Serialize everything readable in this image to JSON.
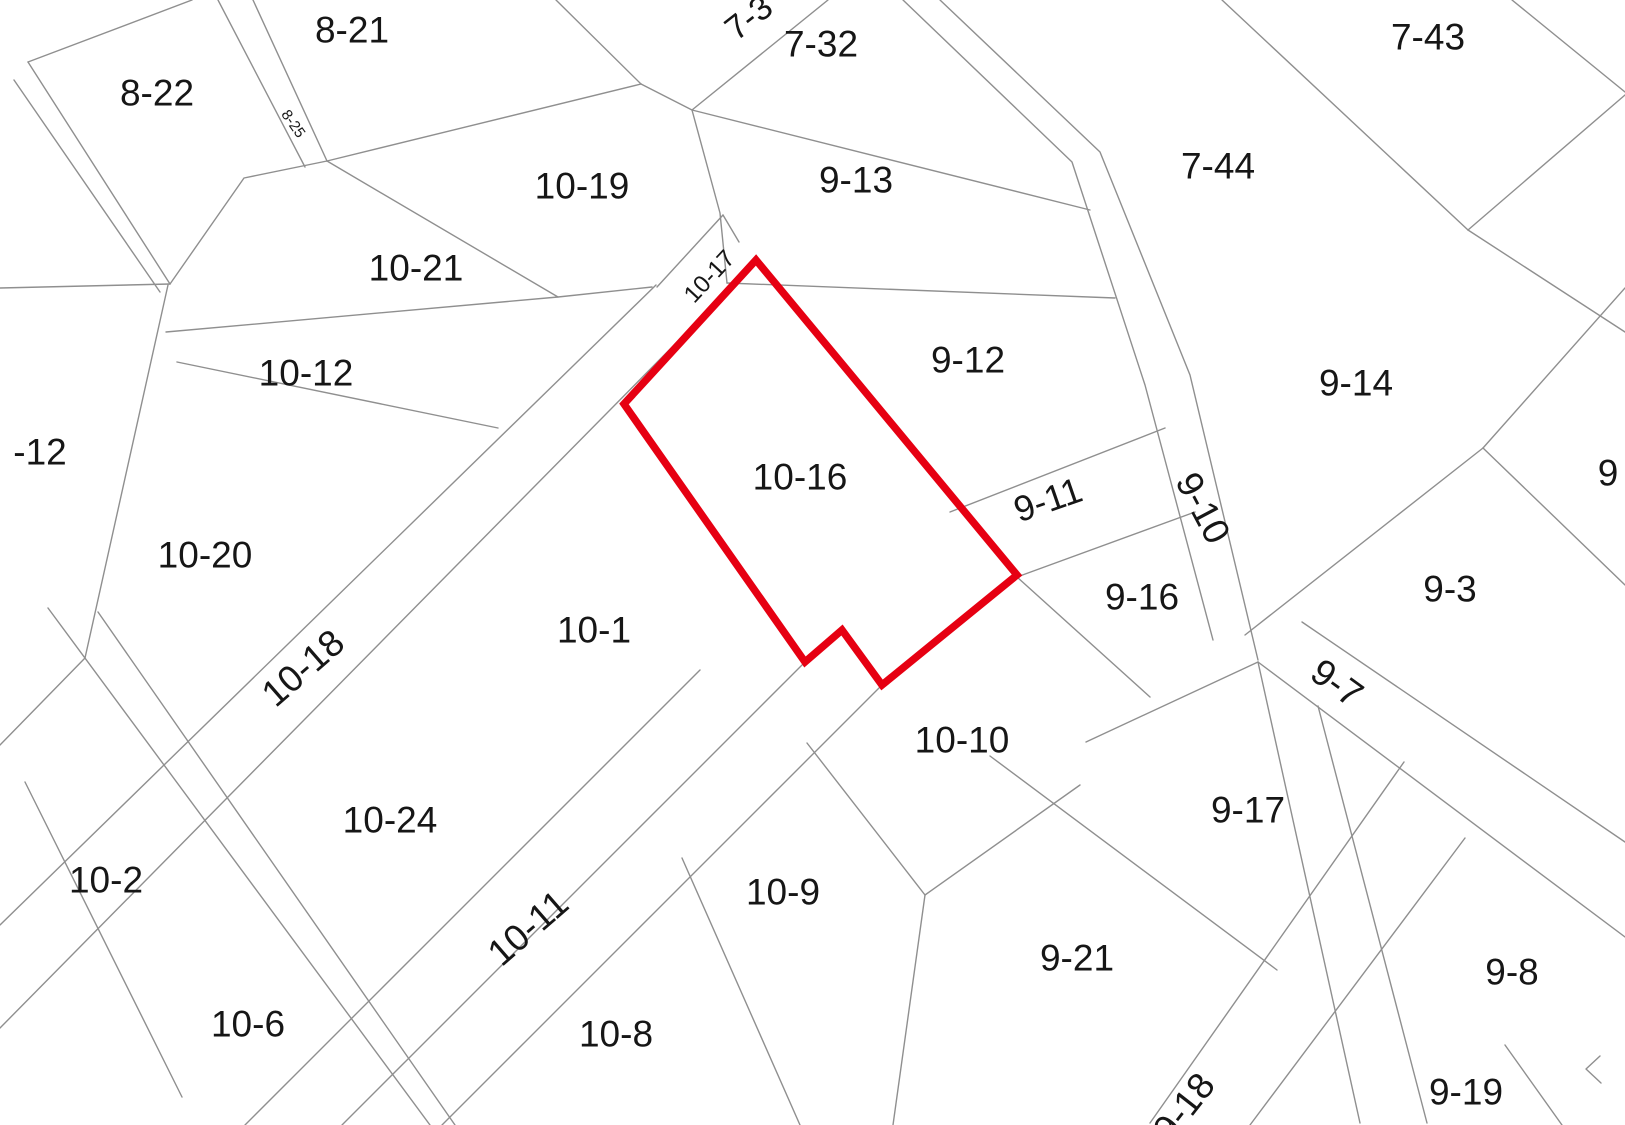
{
  "map": {
    "type": "cadastral-parcel-map",
    "background_color": "#ffffff",
    "boundary_line_color": "#8f8f8f",
    "highlight_color": "#e60012",
    "selected_parcel": "10-16",
    "labels": [
      {
        "text": "8-22",
        "x": 157,
        "y": 93
      },
      {
        "text": "8-21",
        "x": 352,
        "y": 30
      },
      {
        "text": "8-25",
        "x": 293,
        "y": 124,
        "rot": 55,
        "size": 15
      },
      {
        "text": "7-3",
        "x": 749,
        "y": 18,
        "rot": -38,
        "size": 34
      },
      {
        "text": "7-32",
        "x": 821,
        "y": 44
      },
      {
        "text": "7-43",
        "x": 1428,
        "y": 37
      },
      {
        "text": "10-19",
        "x": 582,
        "y": 186
      },
      {
        "text": "9-13",
        "x": 856,
        "y": 180
      },
      {
        "text": "7-44",
        "x": 1218,
        "y": 166
      },
      {
        "text": "10-21",
        "x": 416,
        "y": 268
      },
      {
        "text": "10-17",
        "x": 710,
        "y": 277,
        "rot": -47,
        "size": 24
      },
      {
        "text": "10-12",
        "x": 306,
        "y": 373
      },
      {
        "text": "-12",
        "x": 40,
        "y": 452
      },
      {
        "text": "9-12",
        "x": 968,
        "y": 360
      },
      {
        "text": "9-14",
        "x": 1356,
        "y": 383
      },
      {
        "text": "10-16",
        "x": 800,
        "y": 477
      },
      {
        "text": "9-10",
        "x": 1203,
        "y": 508,
        "rot": 62
      },
      {
        "text": "9-11",
        "x": 1048,
        "y": 500,
        "rot": -19,
        "size": 36
      },
      {
        "text": "10-20",
        "x": 205,
        "y": 555
      },
      {
        "text": "9-16",
        "x": 1142,
        "y": 597
      },
      {
        "text": "9-3",
        "x": 1450,
        "y": 589
      },
      {
        "text": "9",
        "x": 1608,
        "y": 473
      },
      {
        "text": "10-1",
        "x": 594,
        "y": 630
      },
      {
        "text": "10-18",
        "x": 303,
        "y": 668,
        "rot": -41
      },
      {
        "text": "9-7",
        "x": 1337,
        "y": 683,
        "rot": 36
      },
      {
        "text": "10-10",
        "x": 962,
        "y": 740
      },
      {
        "text": "9-17",
        "x": 1248,
        "y": 810
      },
      {
        "text": "10-24",
        "x": 390,
        "y": 820
      },
      {
        "text": "10-2",
        "x": 106,
        "y": 880
      },
      {
        "text": "10-9",
        "x": 783,
        "y": 892
      },
      {
        "text": "10-11",
        "x": 528,
        "y": 928,
        "rot": -41
      },
      {
        "text": "9-21",
        "x": 1077,
        "y": 958
      },
      {
        "text": "9-8",
        "x": 1512,
        "y": 972
      },
      {
        "text": "10-6",
        "x": 248,
        "y": 1024
      },
      {
        "text": "10-8",
        "x": 616,
        "y": 1034
      },
      {
        "text": "9-19",
        "x": 1466,
        "y": 1092
      },
      {
        "text": "9-18",
        "x": 1184,
        "y": 1107,
        "rot": -52
      }
    ],
    "boundary_lines": [
      [
        [
          0,
          288
        ],
        [
          170,
          284
        ]
      ],
      [
        [
          28,
          62
        ],
        [
          192,
          0
        ]
      ],
      [
        [
          28,
          62
        ],
        [
          170,
          284
        ]
      ],
      [
        [
          14,
          80
        ],
        [
          160,
          292
        ]
      ],
      [
        [
          218,
          0
        ],
        [
          305,
          167
        ]
      ],
      [
        [
          253,
          0
        ],
        [
          327,
          161
        ]
      ],
      [
        [
          170,
          284
        ],
        [
          244,
          178
        ],
        [
          327,
          161
        ]
      ],
      [
        [
          327,
          161
        ],
        [
          641,
          84
        ]
      ],
      [
        [
          641,
          84
        ],
        [
          556,
          0
        ]
      ],
      [
        [
          641,
          84
        ],
        [
          692,
          110
        ]
      ],
      [
        [
          828,
          0
        ],
        [
          692,
          110
        ]
      ],
      [
        [
          692,
          110
        ],
        [
          1090,
          210
        ]
      ],
      [
        [
          903,
          0
        ],
        [
          1072,
          162
        ],
        [
          1145,
          385
        ],
        [
          1213,
          640
        ]
      ],
      [
        [
          940,
          0
        ],
        [
          1100,
          152
        ],
        [
          1190,
          375
        ],
        [
          1258,
          660
        ]
      ],
      [
        [
          1222,
          0
        ],
        [
          1468,
          230
        ]
      ],
      [
        [
          1468,
          230
        ],
        [
          1625,
          95
        ]
      ],
      [
        [
          1512,
          0
        ],
        [
          1625,
          92
        ]
      ],
      [
        [
          1468,
          230
        ],
        [
          1625,
          332
        ]
      ],
      [
        [
          1483,
          448
        ],
        [
          1625,
          288
        ]
      ],
      [
        [
          1483,
          448
        ],
        [
          1625,
          585
        ]
      ],
      [
        [
          1483,
          448
        ],
        [
          1245,
          635
        ]
      ],
      [
        [
          1302,
          622
        ],
        [
          1625,
          842
        ]
      ],
      [
        [
          1258,
          662
        ],
        [
          1625,
          937
        ]
      ],
      [
        [
          1404,
          762
        ],
        [
          1150,
          1123
        ]
      ],
      [
        [
          1465,
          838
        ],
        [
          1250,
          1125
        ]
      ],
      [
        [
          1258,
          662
        ],
        [
          1360,
          1123
        ]
      ],
      [
        [
          1318,
          706
        ],
        [
          1427,
          1123
        ]
      ],
      [
        [
          1086,
          742
        ],
        [
          1258,
          662
        ]
      ],
      [
        [
          990,
          756
        ],
        [
          1277,
          970
        ]
      ],
      [
        [
          1017,
          577
        ],
        [
          1150,
          697
        ]
      ],
      [
        [
          950,
          512
        ],
        [
          1165,
          428
        ]
      ],
      [
        [
          1017,
          577
        ],
        [
          1195,
          512
        ]
      ],
      [
        [
          727,
          283
        ],
        [
          1115,
          298
        ]
      ],
      [
        [
          692,
          110
        ],
        [
          720,
          213
        ],
        [
          727,
          283
        ]
      ],
      [
        [
          657,
          287
        ],
        [
          723,
          215
        ]
      ],
      [
        [
          723,
          215
        ],
        [
          739,
          242
        ]
      ],
      [
        [
          656,
          285
        ],
        [
          0,
          925
        ]
      ],
      [
        [
          756,
          262
        ],
        [
          0,
          1028
        ]
      ],
      [
        [
          327,
          161
        ],
        [
          558,
          297
        ]
      ],
      [
        [
          166,
          332
        ],
        [
          558,
          297
        ],
        [
          652,
          287
        ]
      ],
      [
        [
          177,
          362
        ],
        [
          498,
          428
        ]
      ],
      [
        [
          168,
          285
        ],
        [
          85,
          658
        ]
      ],
      [
        [
          85,
          658
        ],
        [
          0,
          745
        ]
      ],
      [
        [
          48,
          608
        ],
        [
          430,
          1125
        ]
      ],
      [
        [
          98,
          612
        ],
        [
          455,
          1125
        ]
      ],
      [
        [
          700,
          670
        ],
        [
          245,
          1125
        ]
      ],
      [
        [
          805,
          662
        ],
        [
          342,
          1125
        ]
      ],
      [
        [
          882,
          685
        ],
        [
          442,
          1125
        ]
      ],
      [
        [
          25,
          782
        ],
        [
          182,
          1097
        ]
      ],
      [
        [
          682,
          858
        ],
        [
          800,
          1125
        ]
      ],
      [
        [
          807,
          743
        ],
        [
          925,
          895
        ],
        [
          893,
          1125
        ]
      ],
      [
        [
          925,
          895
        ],
        [
          1080,
          785
        ]
      ],
      [
        [
          1505,
          1045
        ],
        [
          1562,
          1125
        ]
      ],
      [
        [
          1600,
          1056
        ],
        [
          1586,
          1069
        ],
        [
          1601,
          1083
        ]
      ]
    ],
    "highlight_polygon": [
      [
        756,
        260
      ],
      [
        1017,
        575
      ],
      [
        882,
        685
      ],
      [
        842,
        630
      ],
      [
        805,
        662
      ],
      [
        624,
        404
      ]
    ]
  }
}
